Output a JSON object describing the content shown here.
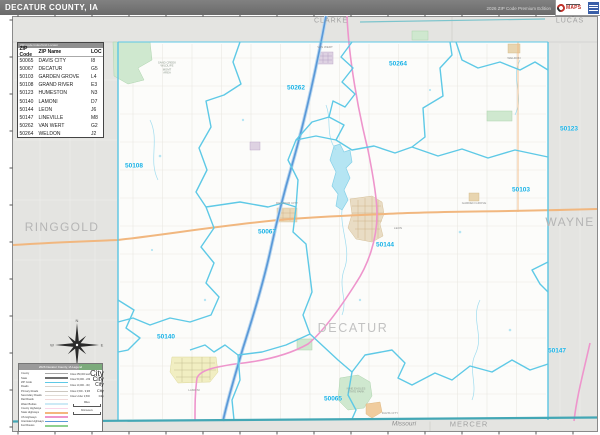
{
  "header": {
    "title": "DECATUR COUNTY, IA",
    "edition": "2026 ZIP Code Premium Edition"
  },
  "logo": {
    "brand": "MAPS"
  },
  "zip_table": {
    "title": "ZIP Code Index/Grid Locator",
    "columns": [
      "ZIP Code",
      "ZIP Name",
      "LOC"
    ],
    "rows": [
      {
        "zip": "50065",
        "name": "DAVIS CITY",
        "loc": "I8"
      },
      {
        "zip": "50067",
        "name": "DECATUR",
        "loc": "G5"
      },
      {
        "zip": "50103",
        "name": "GARDEN GROVE",
        "loc": "L4"
      },
      {
        "zip": "50108",
        "name": "GRAND RIVER",
        "loc": "E3"
      },
      {
        "zip": "50123",
        "name": "HUMESTON",
        "loc": "N3"
      },
      {
        "zip": "50140",
        "name": "LAMONI",
        "loc": "D7"
      },
      {
        "zip": "50144",
        "name": "LEON",
        "loc": "J6"
      },
      {
        "zip": "50147",
        "name": "LINEVILLE",
        "loc": "M8"
      },
      {
        "zip": "50262",
        "name": "VAN WERT",
        "loc": "G2"
      },
      {
        "zip": "50264",
        "name": "WELDON",
        "loc": "J2"
      }
    ]
  },
  "map": {
    "county_label": "DECATUR",
    "neighbors": {
      "west": "RINGGOLD",
      "east": "WAYNE",
      "north_left": "CLARKE",
      "north_right": "LUCAS",
      "south_state": "Missouri",
      "south_county": "MERCER"
    },
    "zip_labels": [
      {
        "text": "50264",
        "x": 398,
        "y": 64
      },
      {
        "text": "50262",
        "x": 296,
        "y": 88
      },
      {
        "text": "50108",
        "x": 134,
        "y": 166
      },
      {
        "text": "50123",
        "x": 569,
        "y": 129
      },
      {
        "text": "50103",
        "x": 521,
        "y": 190
      },
      {
        "text": "50067",
        "x": 267,
        "y": 232
      },
      {
        "text": "50144",
        "x": 385,
        "y": 245
      },
      {
        "text": "50140",
        "x": 166,
        "y": 337
      },
      {
        "text": "50147",
        "x": 557,
        "y": 351
      },
      {
        "text": "50065",
        "x": 333,
        "y": 399
      }
    ],
    "towns": [
      {
        "name": "VAN WERT",
        "x": 325,
        "y": 47
      },
      {
        "name": "WELDON",
        "x": 514,
        "y": 58
      },
      {
        "name": "GARDEN GROVE",
        "x": 474,
        "y": 203
      },
      {
        "name": "LEON",
        "x": 398,
        "y": 228
      },
      {
        "name": "DECATUR CITY",
        "x": 287,
        "y": 203
      },
      {
        "name": "LAMONI",
        "x": 194,
        "y": 390
      },
      {
        "name": "DAVIS CITY",
        "x": 390,
        "y": 413
      }
    ],
    "areas": [
      {
        "text": "SAND CREEK\nWILDLIFE\nMGMT\nAREA",
        "x": 167,
        "y": 68
      },
      {
        "text": "NINE EAGLES\nSTATE PARK",
        "x": 356,
        "y": 391
      }
    ]
  },
  "legend": {
    "title": "2026 Decatur County, IA Legend",
    "city_sample": "City",
    "items": [
      {
        "label": "County",
        "color": "#a8a8a8",
        "h": 1.6
      },
      {
        "label": "State",
        "color": "#6e6e6e",
        "h": 1.6
      },
      {
        "label": "ZIP Code",
        "color": "#5ec9e6",
        "h": 1.6
      },
      {
        "label": "Roads",
        "color": "#d8d4ce",
        "h": 0.8
      },
      {
        "label": "Primary Roads",
        "color": "#cdc8c0",
        "h": 0.8
      },
      {
        "label": "Secondary Roads",
        "color": "#e0dcd6",
        "h": 0.8
      },
      {
        "label": "Rail Roads",
        "color": "#f0dada",
        "h": 1.0
      },
      {
        "label": "Water Bodies",
        "color": "#cdeaf6",
        "h": 2.6
      },
      {
        "label": "County Highways",
        "color": "#f8d6e8",
        "h": 1.8
      },
      {
        "label": "State Highways",
        "color": "#f4b67e",
        "h": 1.8
      },
      {
        "label": "US Highways",
        "color": "#ee95cc",
        "h": 1.8
      },
      {
        "label": "Interstate Highways",
        "color": "#5a99d8",
        "h": 1.8
      },
      {
        "label": "Fed Routes",
        "color": "#8fd08f",
        "h": 1.8
      }
    ],
    "cities": [
      {
        "label": "Cities 250,000 and Above",
        "size": 8
      },
      {
        "label": "Cities 50,000 - 249,999",
        "size": 6.5
      },
      {
        "label": "Cities 10,000 - 49,999",
        "size": 5
      },
      {
        "label": "Cities 2,500 - 9,999",
        "size": 4
      },
      {
        "label": "Cities Under 2,500",
        "size": 3
      }
    ],
    "scales": [
      {
        "label": "Miles"
      },
      {
        "label": "Kilometers"
      }
    ]
  },
  "compass": {
    "points": [
      "N",
      "E",
      "S",
      "W"
    ]
  },
  "colors": {
    "zip_boundary": "#5ec9e6",
    "zip_label": "#18b2e6",
    "interstate": "#5a99d8",
    "us_highway": "#ee95cc",
    "primary_road": "#f1b77f",
    "state_line": "#43a7b5",
    "outside_fill": "#e4e4e1",
    "water": "#b5e5f3",
    "park": "#cfe8cf"
  }
}
